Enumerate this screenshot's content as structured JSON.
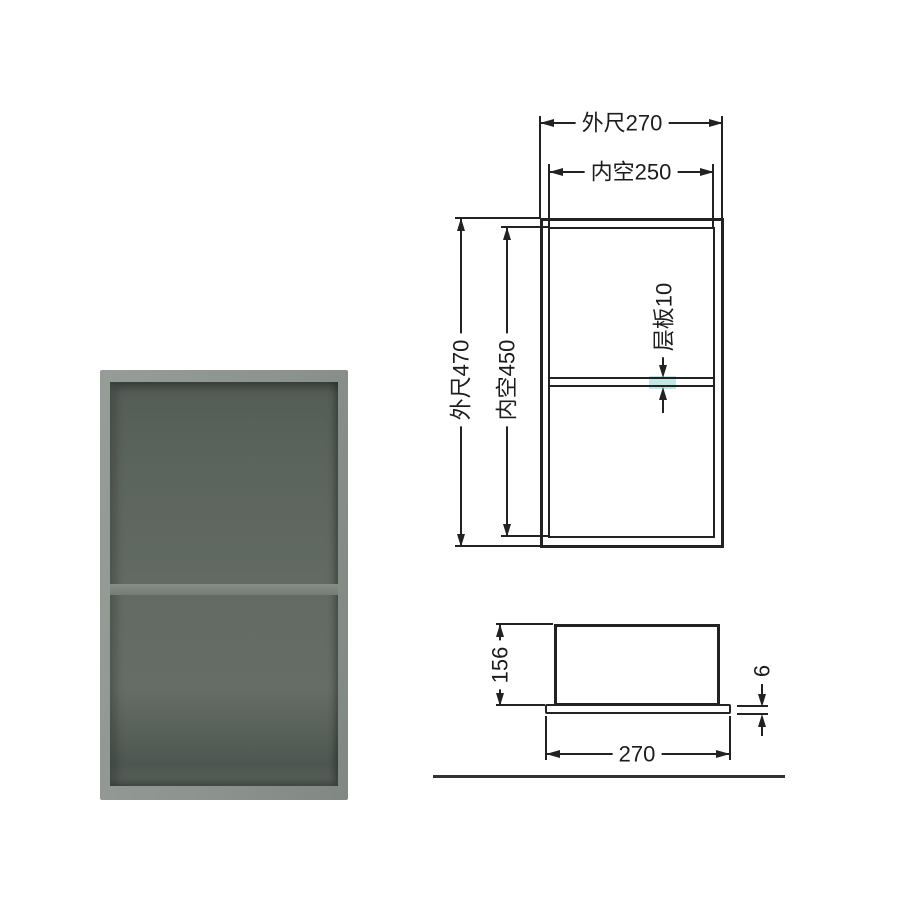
{
  "colors": {
    "line": "#222222",
    "shelf_highlight": "#c3e7e4",
    "ground_line": "#333333",
    "photo_frame": "#8e948f",
    "photo_interior": "#616860",
    "photo_shelf": "#7b837d"
  },
  "front_view": {
    "outer_width_label": "外尺270",
    "inner_width_label": "内空250",
    "outer_height_label": "外尺470",
    "inner_height_label": "内空450",
    "shelf_label": "层板10"
  },
  "side_view": {
    "height_label": "156",
    "flange_thickness_label": "6",
    "width_label": "270"
  }
}
